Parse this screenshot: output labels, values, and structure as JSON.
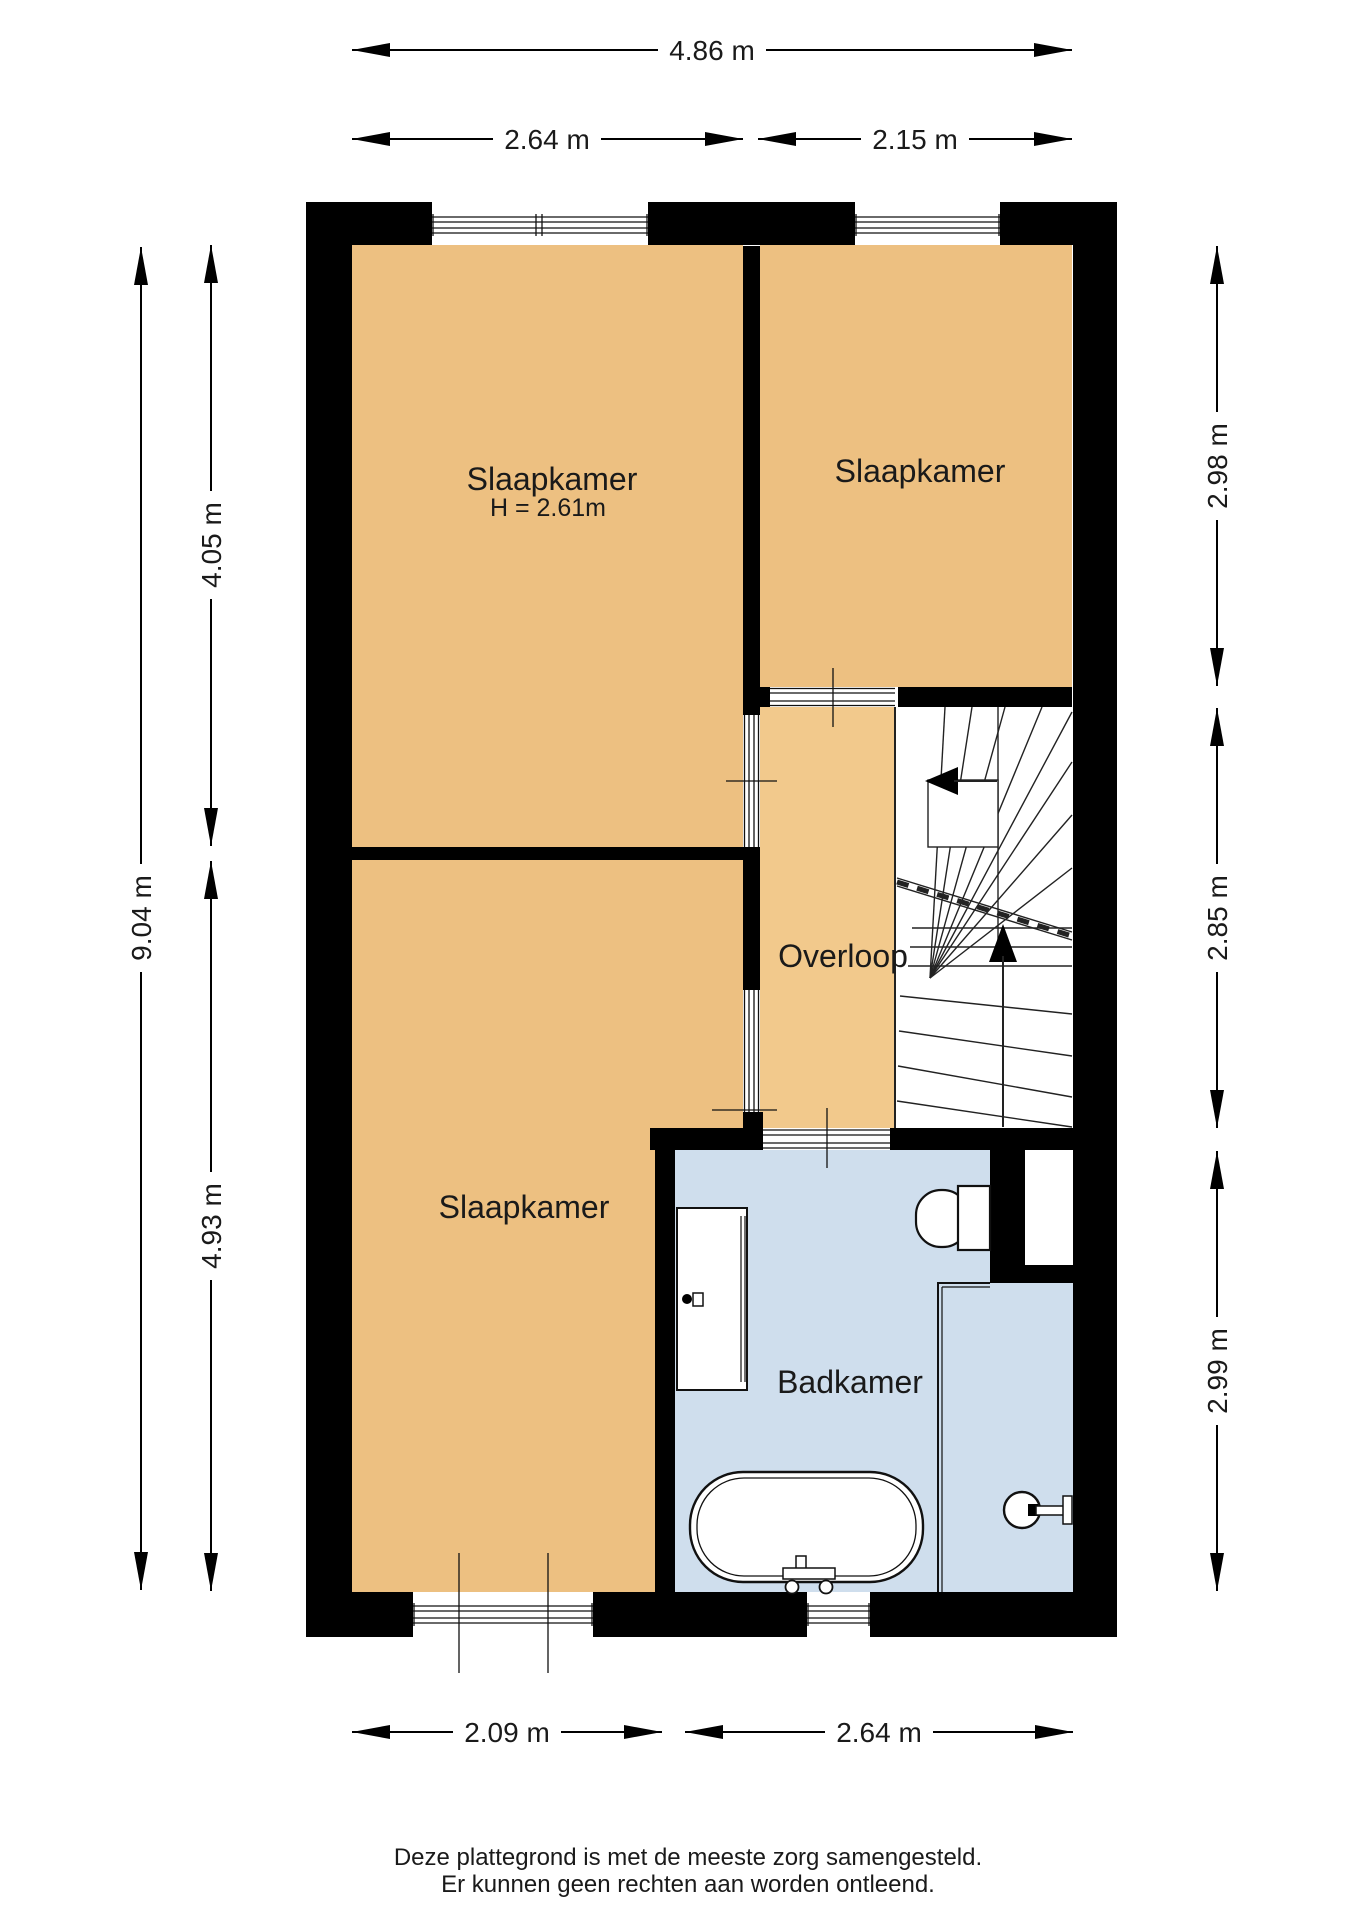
{
  "colors": {
    "background": "#ffffff",
    "wall": "#000000",
    "bedroom_fill": "#edc081",
    "landing_fill": "#f2c98c",
    "bathroom_fill": "#cfdeed",
    "line": "#1a1a1a"
  },
  "rooms": [
    {
      "name": "slaapkamer-top-left",
      "label": "Slaapkamer",
      "height_label": "H = 2.61m"
    },
    {
      "name": "slaapkamer-top-right",
      "label": "Slaapkamer"
    },
    {
      "name": "slaapkamer-bottom-left",
      "label": "Slaapkamer"
    },
    {
      "name": "overloop",
      "label": "Overloop"
    },
    {
      "name": "badkamer",
      "label": "Badkamer"
    }
  ],
  "dimensions": {
    "top": [
      {
        "label": "4.86 m"
      },
      {
        "label": "2.64 m"
      },
      {
        "label": "2.15 m"
      }
    ],
    "bottom": [
      {
        "label": "2.09 m"
      },
      {
        "label": "2.64 m"
      }
    ],
    "left": [
      {
        "label": "9.04 m"
      },
      {
        "label": "4.05 m"
      },
      {
        "label": "4.93 m"
      }
    ],
    "right": [
      {
        "label": "2.98 m"
      },
      {
        "label": "2.85 m"
      },
      {
        "label": "2.99 m"
      }
    ]
  },
  "fixtures": [
    {
      "name": "staircase"
    },
    {
      "name": "washbasin"
    },
    {
      "name": "toilet"
    },
    {
      "name": "bathtub"
    },
    {
      "name": "shower"
    }
  ],
  "footer": {
    "line1": "Deze plattegrond is met de meeste zorg samengesteld.",
    "line2": "Er kunnen geen rechten aan worden ontleend."
  }
}
